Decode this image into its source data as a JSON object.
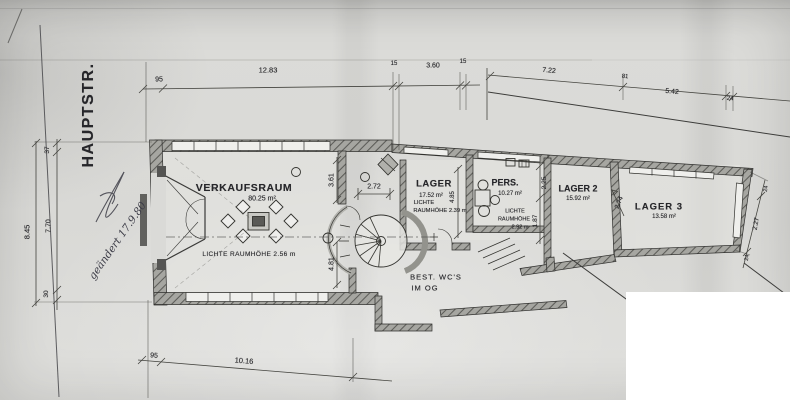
{
  "plan": {
    "street": "HAUPTSTR.",
    "note": "geändert 17.9.80",
    "rooms": {
      "verkaufsraum": {
        "name": "VERKAUFSRAUM",
        "area": "80.25 m²",
        "height": "LICHTE RAUMHÖHE 2.56 m"
      },
      "lager": {
        "name": "LAGER",
        "area": "17.52 m²",
        "height_l1": "LICHTE",
        "height_l2": "RAUMHÖHE 2.39 m"
      },
      "pers": {
        "name": "PERS.",
        "area": "10.27 m²",
        "height_l1": "LICHTE",
        "height_l2": "RAUMHÖHE",
        "height_l3": "2.92 m"
      },
      "lager2": {
        "name": "LAGER 2",
        "area": "15.92 m²"
      },
      "lager3": {
        "name": "LAGER 3",
        "area": "13.58 m²"
      }
    },
    "wc_note": {
      "l1": "BEST. WC'S",
      "l2": "IM OG"
    },
    "dims": {
      "top": {
        "seg1": "95",
        "seg2": "12.83",
        "seg3": "15",
        "seg4": "3.60",
        "seg5": "15"
      },
      "street": {
        "seg1": "7.22",
        "seg2": "81",
        "seg3": "5.42",
        "seg4": "24"
      },
      "left": {
        "seg1": "37",
        "seg2": "7.70",
        "seg3": "30",
        "total": "8.45"
      },
      "bottom": {
        "seg1": "95",
        "seg2": "10.16"
      },
      "interior": {
        "vr_right1": "3.61",
        "vr_right2": "4.81",
        "stair_w": "2.72",
        "lager_d": "4.85",
        "pers_d1": "2.25",
        "pers_d2": "1.87",
        "lager3_w": "2.74",
        "lager3_d": "2.27",
        "lager3_t1": "24",
        "lager3_t2": "24"
      }
    }
  }
}
